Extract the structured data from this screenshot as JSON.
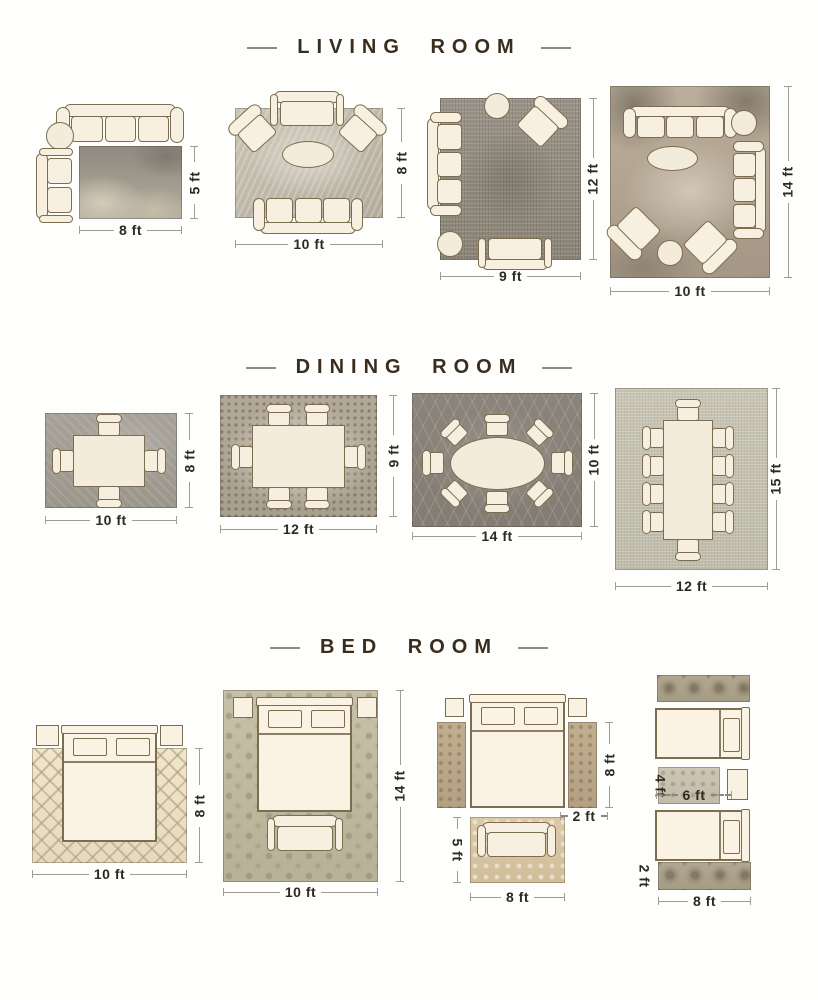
{
  "sections": {
    "living": {
      "title": "LIVING ROOM",
      "layouts": {
        "l1": {
          "w": "8 ft",
          "h": "5 ft"
        },
        "l2": {
          "w": "10 ft",
          "h": "8 ft"
        },
        "l3": {
          "w": "9 ft",
          "h": "12 ft"
        },
        "l4": {
          "w": "10 ft",
          "h": "14 ft"
        }
      }
    },
    "dining": {
      "title": "DINING ROOM",
      "layouts": {
        "d1": {
          "w": "10 ft",
          "h": "8 ft"
        },
        "d2": {
          "w": "12 ft",
          "h": "9 ft"
        },
        "d3": {
          "w": "14 ft",
          "h": "10 ft"
        },
        "d4": {
          "w": "12 ft",
          "h": "15 ft"
        }
      }
    },
    "bedroom": {
      "title": "BED ROOM",
      "layouts": {
        "b1": {
          "w": "10 ft",
          "h": "8 ft"
        },
        "b2": {
          "w": "10 ft",
          "h": "14 ft"
        },
        "b3": {
          "runner_h": "8 ft",
          "runner_w": "2 ft",
          "rug_h": "5 ft",
          "rug_w": "8 ft"
        },
        "b4": {
          "mid_h": "4 ft",
          "mid_w": "6 ft",
          "runner_h": "2 ft",
          "runner_w": "8 ft"
        }
      }
    }
  },
  "colors": {
    "title_text": "#3a2d1e",
    "dimension_text": "#2d2822",
    "furniture_fill": "#f7f0e0",
    "furniture_outline": "#7d6d50"
  }
}
